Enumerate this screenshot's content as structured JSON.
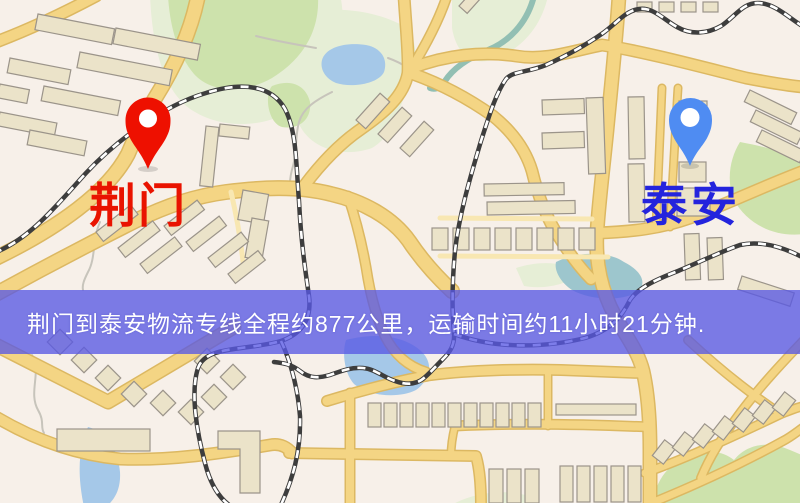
{
  "map": {
    "origin": {
      "name": "荆门",
      "pin_color": "#ee1000",
      "label_color": "#e91300"
    },
    "destination": {
      "name": "泰安",
      "pin_color": "#4f8cf2",
      "label_color": "#2424dd"
    },
    "banner": {
      "text": "荆门到泰安物流专线全程约877公里，运输时间约11小时21分钟.",
      "style": "background:rgba(88,88,228,0.78)",
      "text_color": "#ffffff",
      "distance": "877公里",
      "duration": "11小时21分钟"
    }
  },
  "palette": {
    "background": "#f7f0e9",
    "road": "#f4d584",
    "road_casing": "#dcb862",
    "road_minor": "#f8e7b2",
    "building": "#ebe3c9",
    "building_outline": "#9b948a",
    "park": "#cde2ac",
    "park_pale": "#e6eed6",
    "water": "#a5c8e8",
    "water_teal": "#9dc6cd",
    "river": "#92bfb3",
    "stream": "#c7c4bb",
    "railway_dark": "#3d3d3d",
    "railway_light": "#ffffff"
  }
}
